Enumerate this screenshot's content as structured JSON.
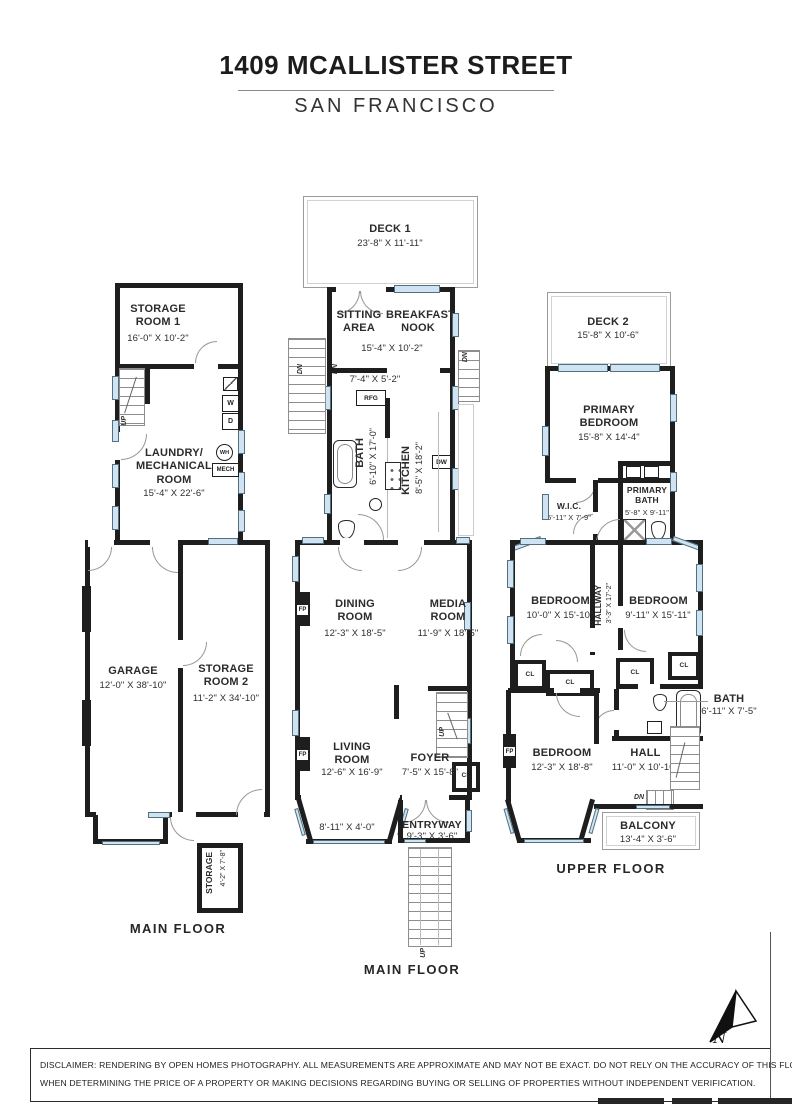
{
  "header": {
    "title": "1409 MCALLISTER STREET",
    "subtitle": "SAN FRANCISCO"
  },
  "floor_labels": {
    "left": "MAIN FLOOR",
    "middle": "MAIN FLOOR",
    "right": "UPPER FLOOR"
  },
  "left_plan": {
    "storage1_name": "STORAGE\nROOM 1",
    "storage1_dims": "16'-0\" X 10'-2\"",
    "laundry_name": "LAUNDRY/\nMECHANICAL\nROOM",
    "laundry_dims": "15'-4\" X 22'-6\"",
    "garage_name": "GARAGE",
    "garage_dims": "12'-0\" X 38'-10\"",
    "storage2_name": "STORAGE\nROOM 2",
    "storage2_dims": "11'-2\" X 34'-10\"",
    "storage3_name": "STORAGE",
    "storage3_dims": "4'-2\" X 7'-8\""
  },
  "middle_plan": {
    "deck1_name": "DECK 1",
    "deck1_dims": "23'-8\" X 11'-11\"",
    "sitting_name": "SITTING\nAREA",
    "breakfast_name": "BREAKFAST\nNOOK",
    "sitting_breakfast_dims": "15'-4\" X 10'-2\"",
    "pantry_dims": "7'-4\" X 5'-2\"",
    "bath_name": "BATH",
    "bath_dims": "6'-10\" X 17'-0\"",
    "kitchen_name": "KITCHEN",
    "kitchen_dims": "8'-5\" X 18'-2\"",
    "dining_name": "DINING\nROOM",
    "dining_dims": "12'-3\" X 18'-5\"",
    "media_name": "MEDIA\nROOM",
    "media_dims": "11'-9\" X 18'-5\"",
    "living_name": "LIVING\nROOM",
    "living_dims": "12'-6\" X 16'-9\"",
    "bay_dims": "8'-11\" X 4'-0\"",
    "foyer_name": "FOYER",
    "foyer_dims": "7'-5\" X 15'-8\"",
    "entryway_name": "ENTRYWAY",
    "entryway_dims": "9'-3\" X 3'-6\""
  },
  "right_plan": {
    "deck2_name": "DECK 2",
    "deck2_dims": "15'-8\" X 10'-6\"",
    "primary_bedroom_name": "PRIMARY\nBEDROOM",
    "primary_bedroom_dims": "15'-8\" X 14'-4\"",
    "wic_name": "W.I.C.",
    "wic_dims": "5'-11\" X 7'-9\"",
    "primary_bath_name": "PRIMARY\nBATH",
    "primary_bath_dims": "5'-8\" X 9'-11\"",
    "bedroom2_name": "BEDROOM",
    "bedroom2_dims": "10'-0\" X 15'-10\"",
    "hallway_name": "HALLWAY",
    "hallway_dims": "3'-3\" X 17'-2\"",
    "bedroom3_name": "BEDROOM",
    "bedroom3_dims": "9'-11\" X 15'-11\"",
    "bath2_name": "BATH",
    "bath2_dims": "6'-11\" X 7'-5\"",
    "bedroom4_name": "BEDROOM",
    "bedroom4_dims": "12'-3\" X 18'-8\"",
    "hall_name": "HALL",
    "hall_dims": "11'-0\" X 10'-10\"",
    "balcony_name": "BALCONY",
    "balcony_dims": "13'-4\" X 3'-6\""
  },
  "fixtures": {
    "washer": "W",
    "dryer": "D",
    "water_heater": "WH",
    "mechanical": "MECH",
    "refrigerator": "RFG",
    "dishwasher": "DW",
    "fireplace": "FP",
    "closet": "CL",
    "up": "UP",
    "down": "DN"
  },
  "compass": {
    "north": "N"
  },
  "footer": {
    "disclaimer_line1": "DISCLAIMER: RENDERING BY OPEN HOMES PHOTOGRAPHY. ALL MEASUREMENTS ARE APPROXIMATE AND MAY NOT BE EXACT. DO NOT RELY ON THE ACCURACY OF THIS FLOOR PLAN",
    "disclaimer_line2": "WHEN DETERMINING THE PRICE OF A PROPERTY OR MAKING DECISIONS REGARDING BUYING OR SELLING OF PROPERTIES WITHOUT INDEPENDENT VERIFICATION."
  }
}
